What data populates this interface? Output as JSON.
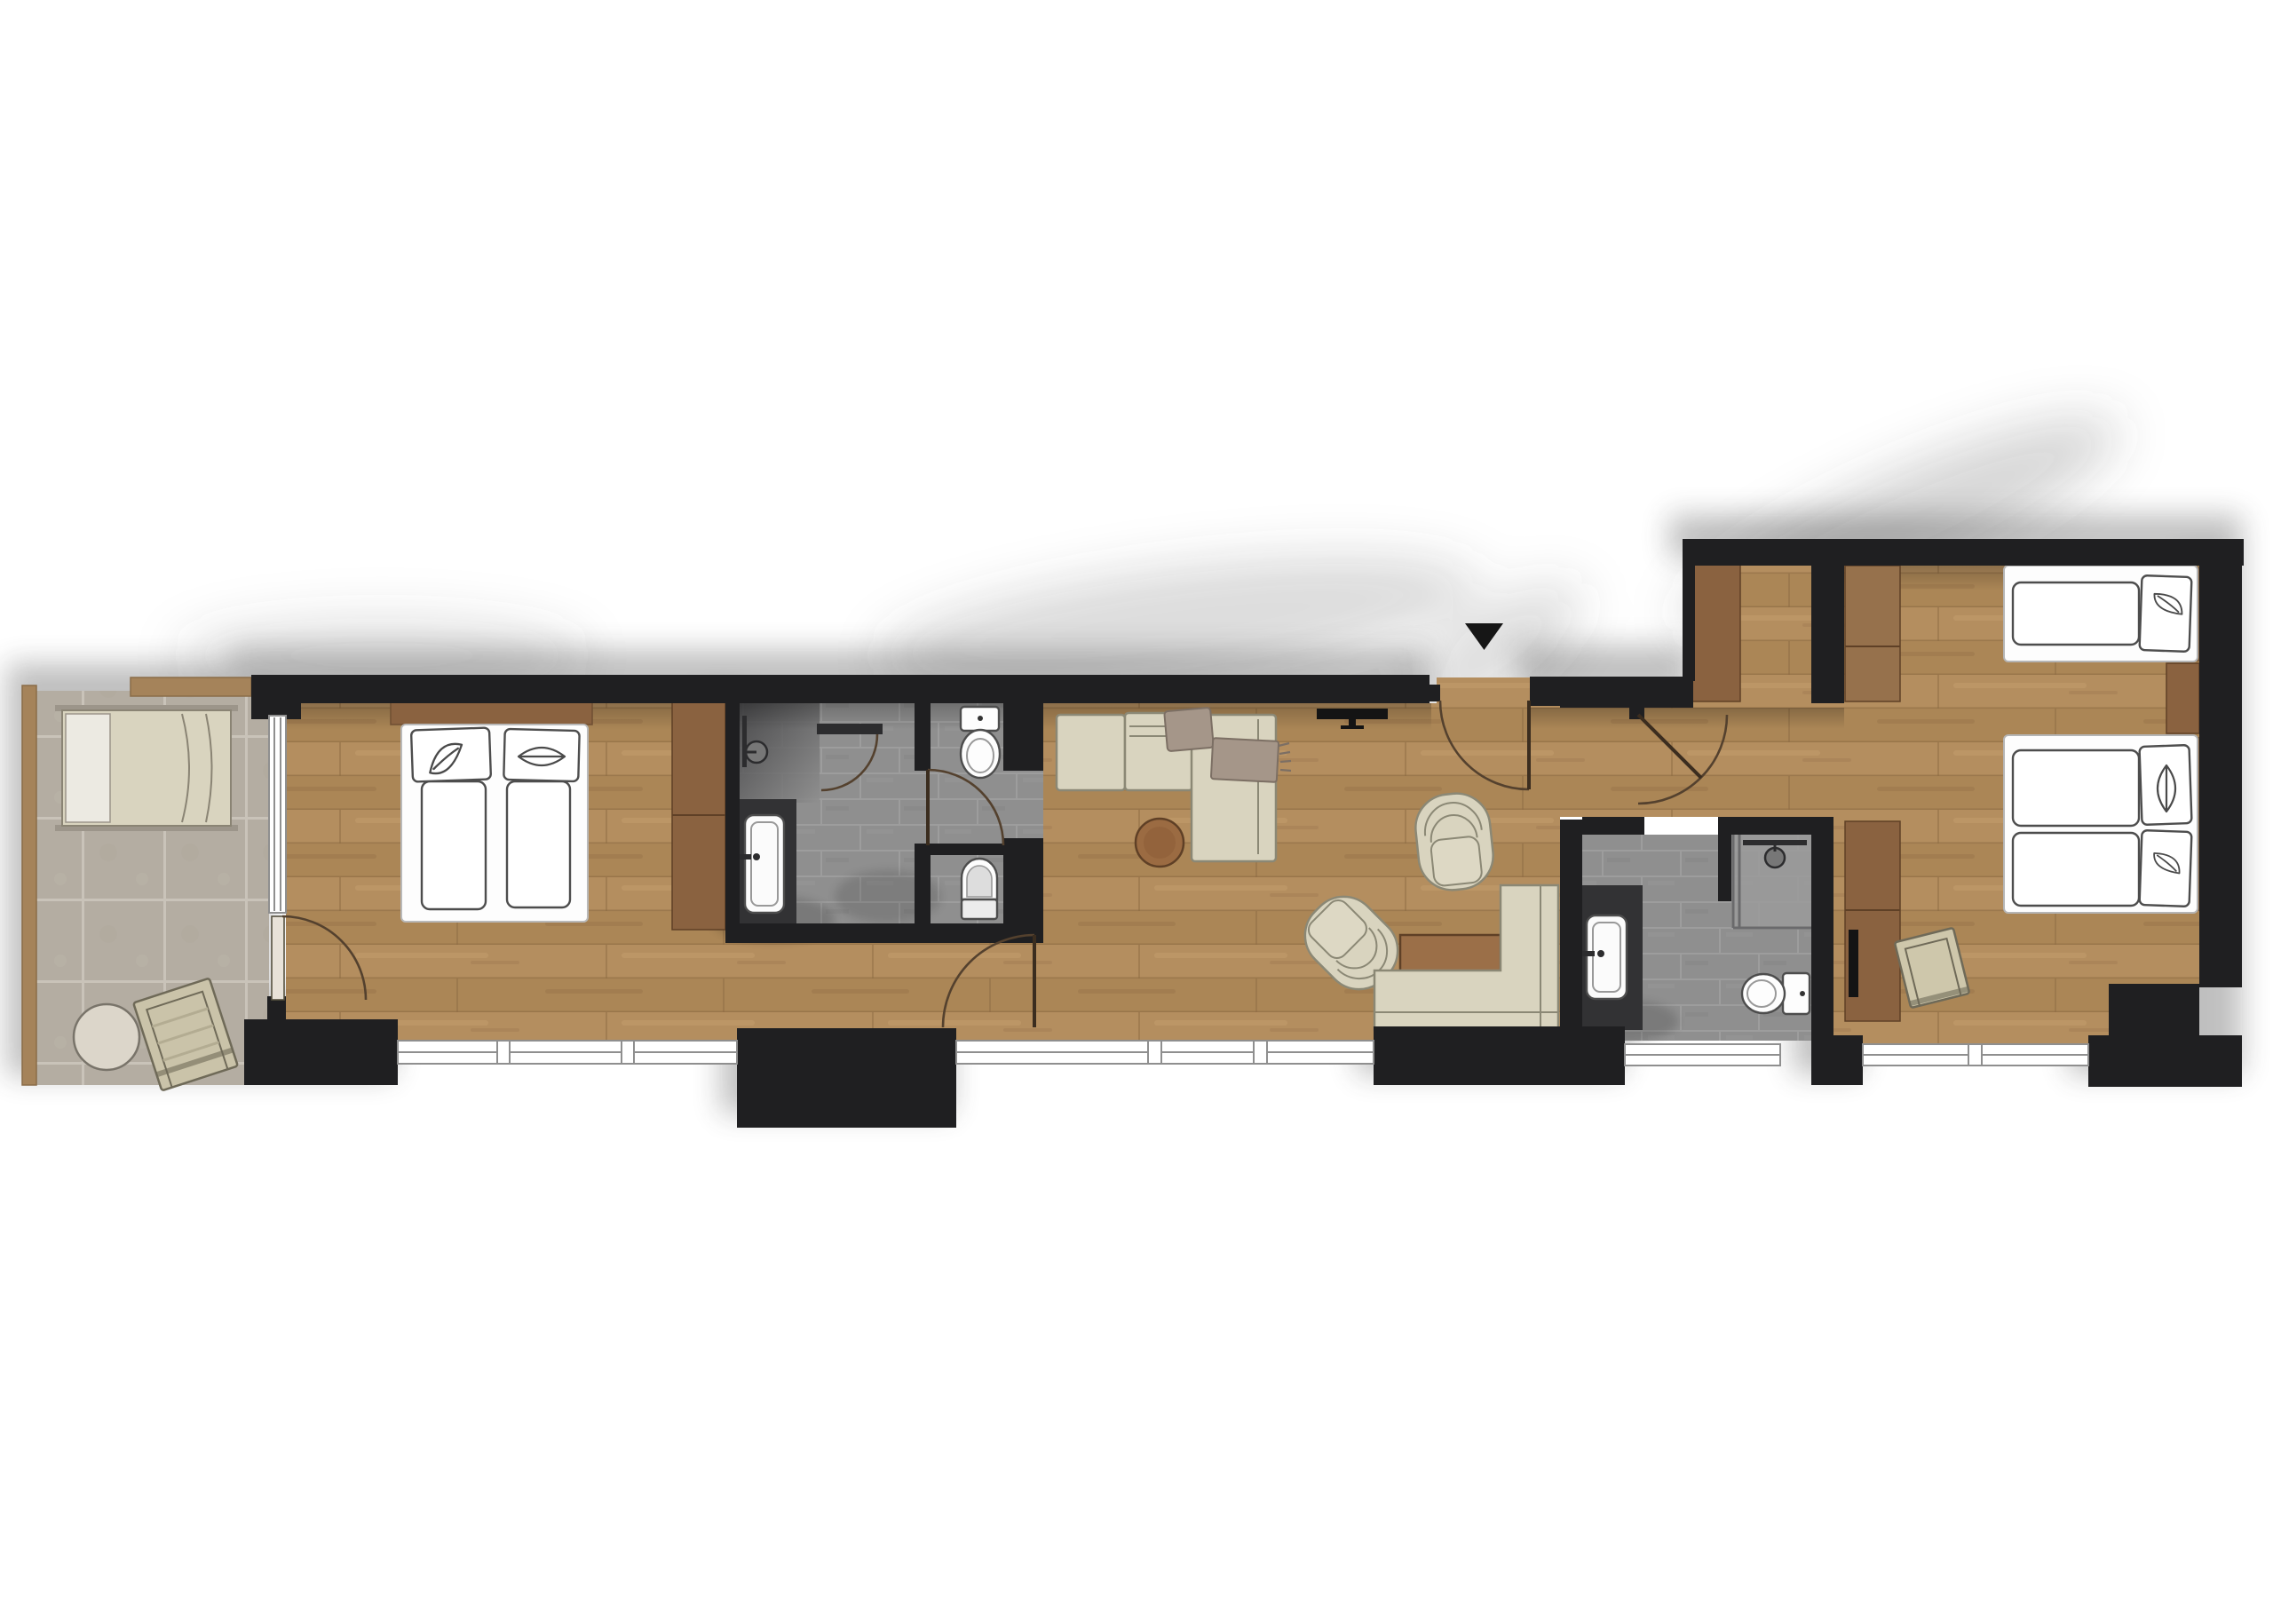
{
  "plan": {
    "kind": "apartment-suite-floor-plan",
    "orientation_marker": "entrance-triangle"
  },
  "colors": {
    "background": "#ffffff",
    "wall": "#1f1f21",
    "wood_floor": "#b48e5f",
    "wood_floor_alt": "#ab8656",
    "wood_joint": "#8d6c44",
    "wood_streak": "#d8b27f",
    "wood_trim": "#a5835a",
    "cabinet_wood": "#8a6240",
    "cabinet_wood_dark": "#6f4f32",
    "headboard_wood": "#7d5c3b",
    "terrace_tile": "#b4ada2",
    "terrace_grout": "#c9c3b9",
    "bath_tile": "#8f8f8f",
    "bath_grout": "#9d9d9d",
    "shower_dark": "#57575a",
    "vanity_counter": "#323234",
    "fixture_white": "#fdfdfd",
    "upholstery": "#d9d4bf",
    "upholstery_line": "#8b8875",
    "blanket": "#a59689",
    "table_wood": "#9b6b42",
    "table_wood_edge": "#5f4026",
    "door_arc": "#54412e",
    "window_fill": "#ffffff",
    "window_frame": "#8f8f8f",
    "tv_black": "#141414",
    "entry_marker": "#161616",
    "shadow": "#3a3a3a"
  },
  "rooms": [
    {
      "id": "terrace",
      "name": "Terrace",
      "floor": "outdoor-tile",
      "furniture": [
        "sun-lounger",
        "round-side-table",
        "folding-deck-chair",
        "glazed-sliding-door"
      ]
    },
    {
      "id": "bedroom-1",
      "name": "Bedroom 1",
      "floor": "wood-planks",
      "furniture": [
        "double-bed",
        "pillow-leaf-sketch",
        "pillow-lips-sketch",
        "wood-headboard",
        "tall-cabinet",
        "wall-tv"
      ]
    },
    {
      "id": "bathroom-1",
      "name": "Bathroom 1",
      "floor": "stone-tile",
      "furniture": [
        "walk-in-shower",
        "shower-door",
        "vanity-basin",
        "toilet-upper-niche",
        "toilet-lower-niche",
        "wc-door"
      ]
    },
    {
      "id": "living-room",
      "name": "Living Room",
      "floor": "wood-planks",
      "furniture": [
        "l-shaped-sofa",
        "blanket",
        "fringed-blanket",
        "round-coffee-table",
        "wall-tv",
        "armchair-top",
        "armchair-bottom",
        "square-wood-table",
        "corner-bench"
      ]
    },
    {
      "id": "entry-hall",
      "name": "Entry Hall",
      "floor": "wood-planks",
      "furniture": [
        "entry-door",
        "hall-wardrobe-column"
      ]
    },
    {
      "id": "bathroom-2",
      "name": "Bathroom 2",
      "floor": "stone-tile",
      "furniture": [
        "vanity-basin",
        "glass-shower",
        "toilet",
        "bath-door"
      ]
    },
    {
      "id": "bedroom-2",
      "name": "Bedroom 2",
      "floor": "wood-planks",
      "furniture": [
        "single-bed",
        "double-bed",
        "pillow-sketches",
        "nightstand",
        "wardrobe-column-upper",
        "wardrobe-column-lower",
        "tv-panel",
        "luggage-stool"
      ]
    }
  ]
}
